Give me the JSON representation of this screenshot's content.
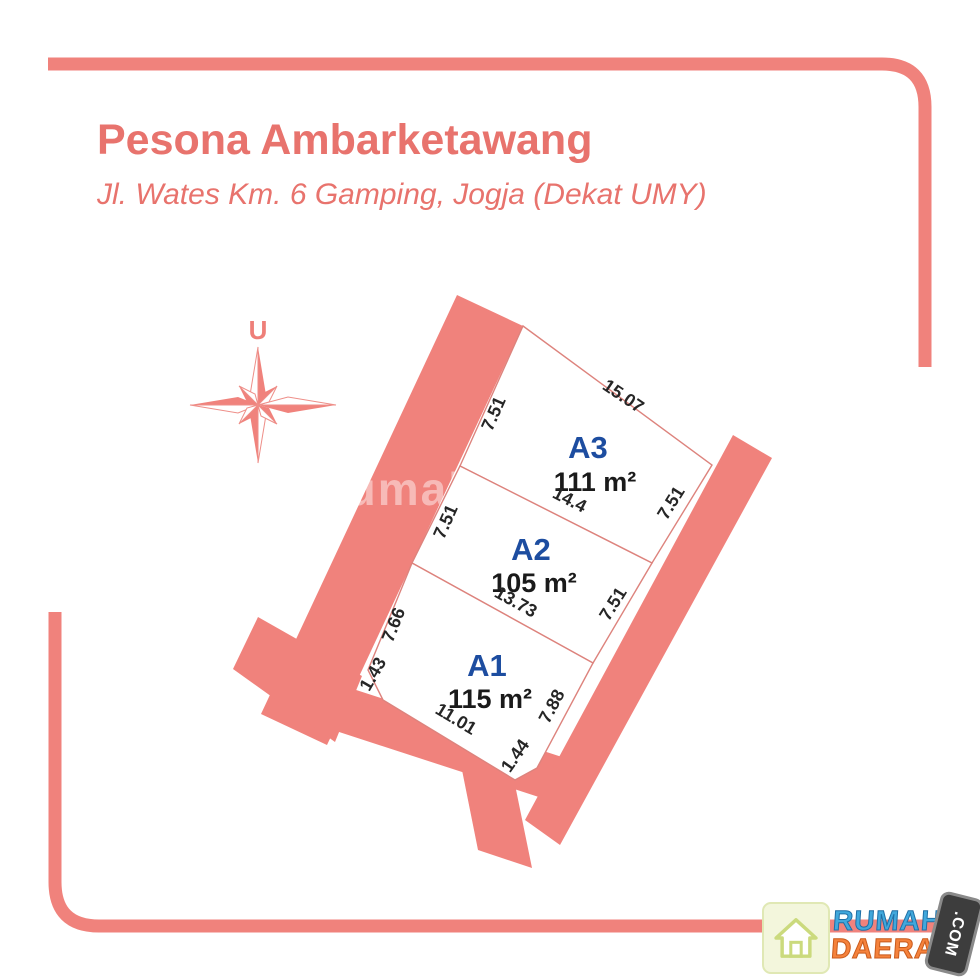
{
  "header": {
    "title": "Pesona Ambarketawang",
    "subtitle": "Jl. Wates Km. 6 Gamping, Jogja (Dekat UMY)"
  },
  "compass": {
    "north_label": "U"
  },
  "watermark": {
    "text": "rumah"
  },
  "plots": [
    {
      "id": "A3",
      "area": "111 m²",
      "dims": {
        "top": "15.07",
        "left": "7.51",
        "bottom": "14.4",
        "right": "7.51"
      }
    },
    {
      "id": "A2",
      "area": "105 m²",
      "dims": {
        "left": "7.51",
        "bottom": "13.73",
        "right": "7.51"
      }
    },
    {
      "id": "A1",
      "area": "115 m²",
      "dims": {
        "left": "7.66",
        "corner_left": "1.43",
        "bottom": "11.01",
        "corner_right": "1.44",
        "right": "7.88"
      }
    }
  ],
  "logo": {
    "name_top": "RUMAH",
    "name_bottom": "DAERAH",
    "badge": ".COM"
  },
  "colors": {
    "accent_salmon": "#f0827c",
    "title_text": "#e8736d",
    "plot_label_blue": "#1d4da0",
    "dimension_text": "#262626",
    "logo_blue": "#41a8dc",
    "logo_orange": "#f5823c",
    "badge_dark": "#3d3d3d"
  }
}
